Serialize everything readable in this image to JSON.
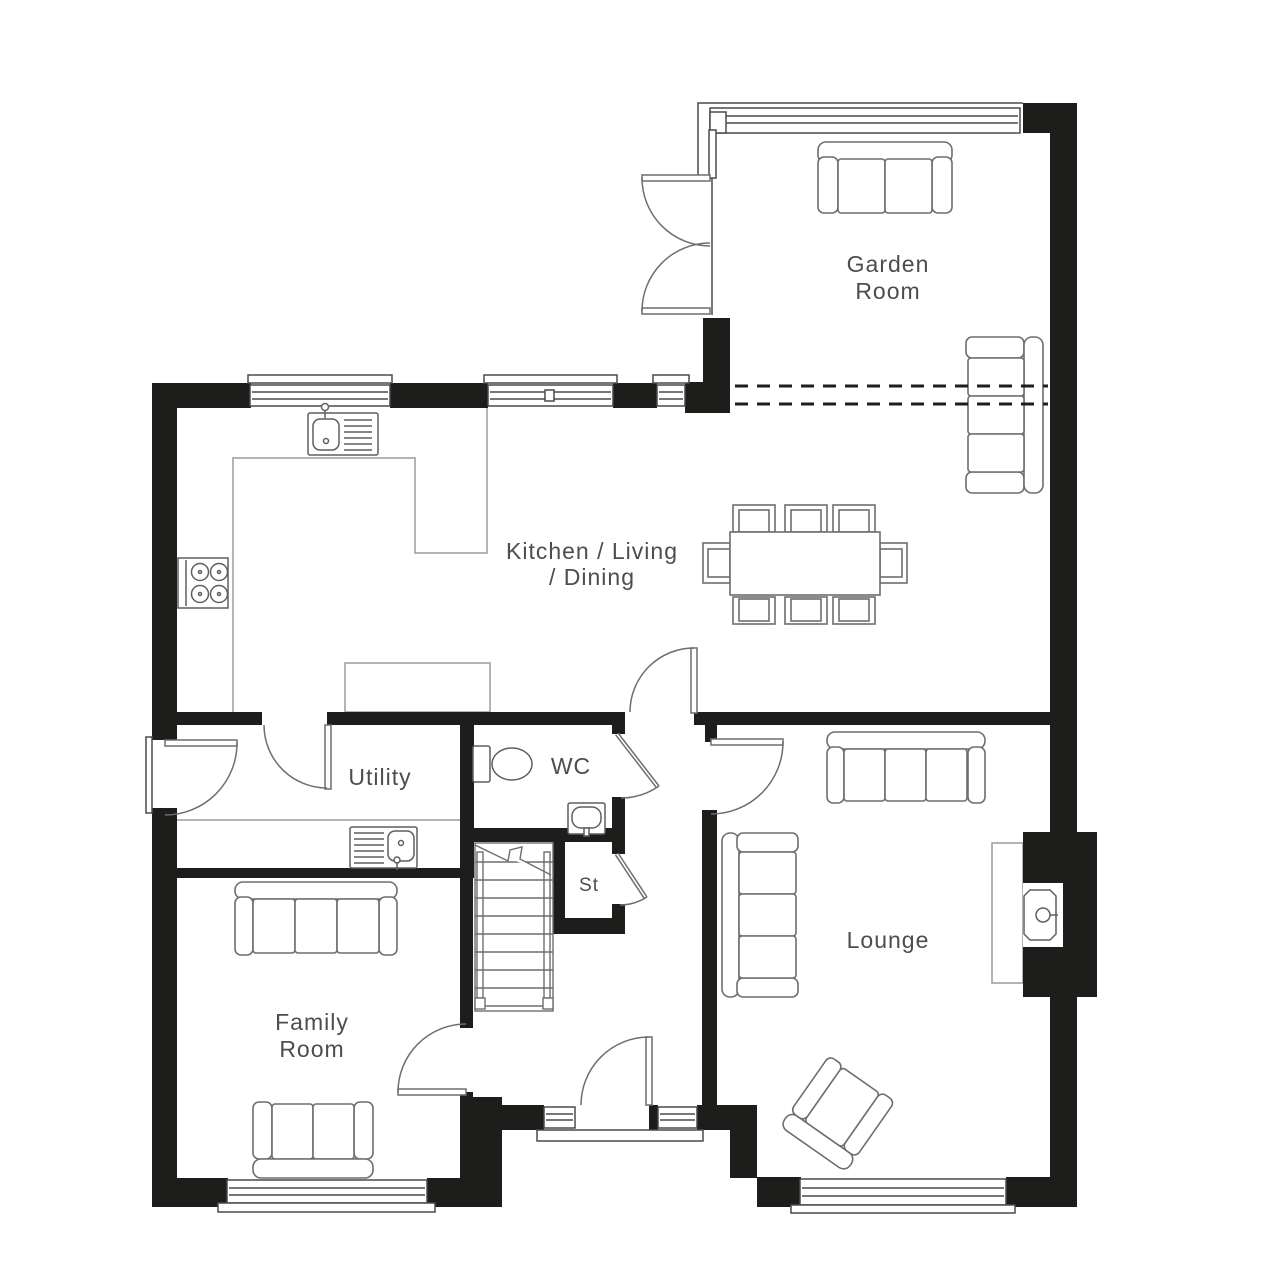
{
  "colors": {
    "background": "#ffffff",
    "wall": "#1d1d1b",
    "furniture": "#6e6e6e",
    "fixture": "#5f5f5f",
    "counter": "#9b9b9b",
    "window": "#4a4a4a",
    "door": "#6e6e6e",
    "label": "#4d4d4d"
  },
  "rooms": {
    "garden_room": {
      "label_line1": "Garden",
      "label_line2": "Room"
    },
    "kitchen_living_dining": {
      "label_line1": "Kitchen / Living",
      "label_line2": "/ Dining"
    },
    "utility": {
      "label": "Utility"
    },
    "wc": {
      "label": "WC"
    },
    "store": {
      "label": "St"
    },
    "family_room": {
      "label_line1": "Family",
      "label_line2": "Room"
    },
    "lounge": {
      "label": "Lounge"
    }
  }
}
